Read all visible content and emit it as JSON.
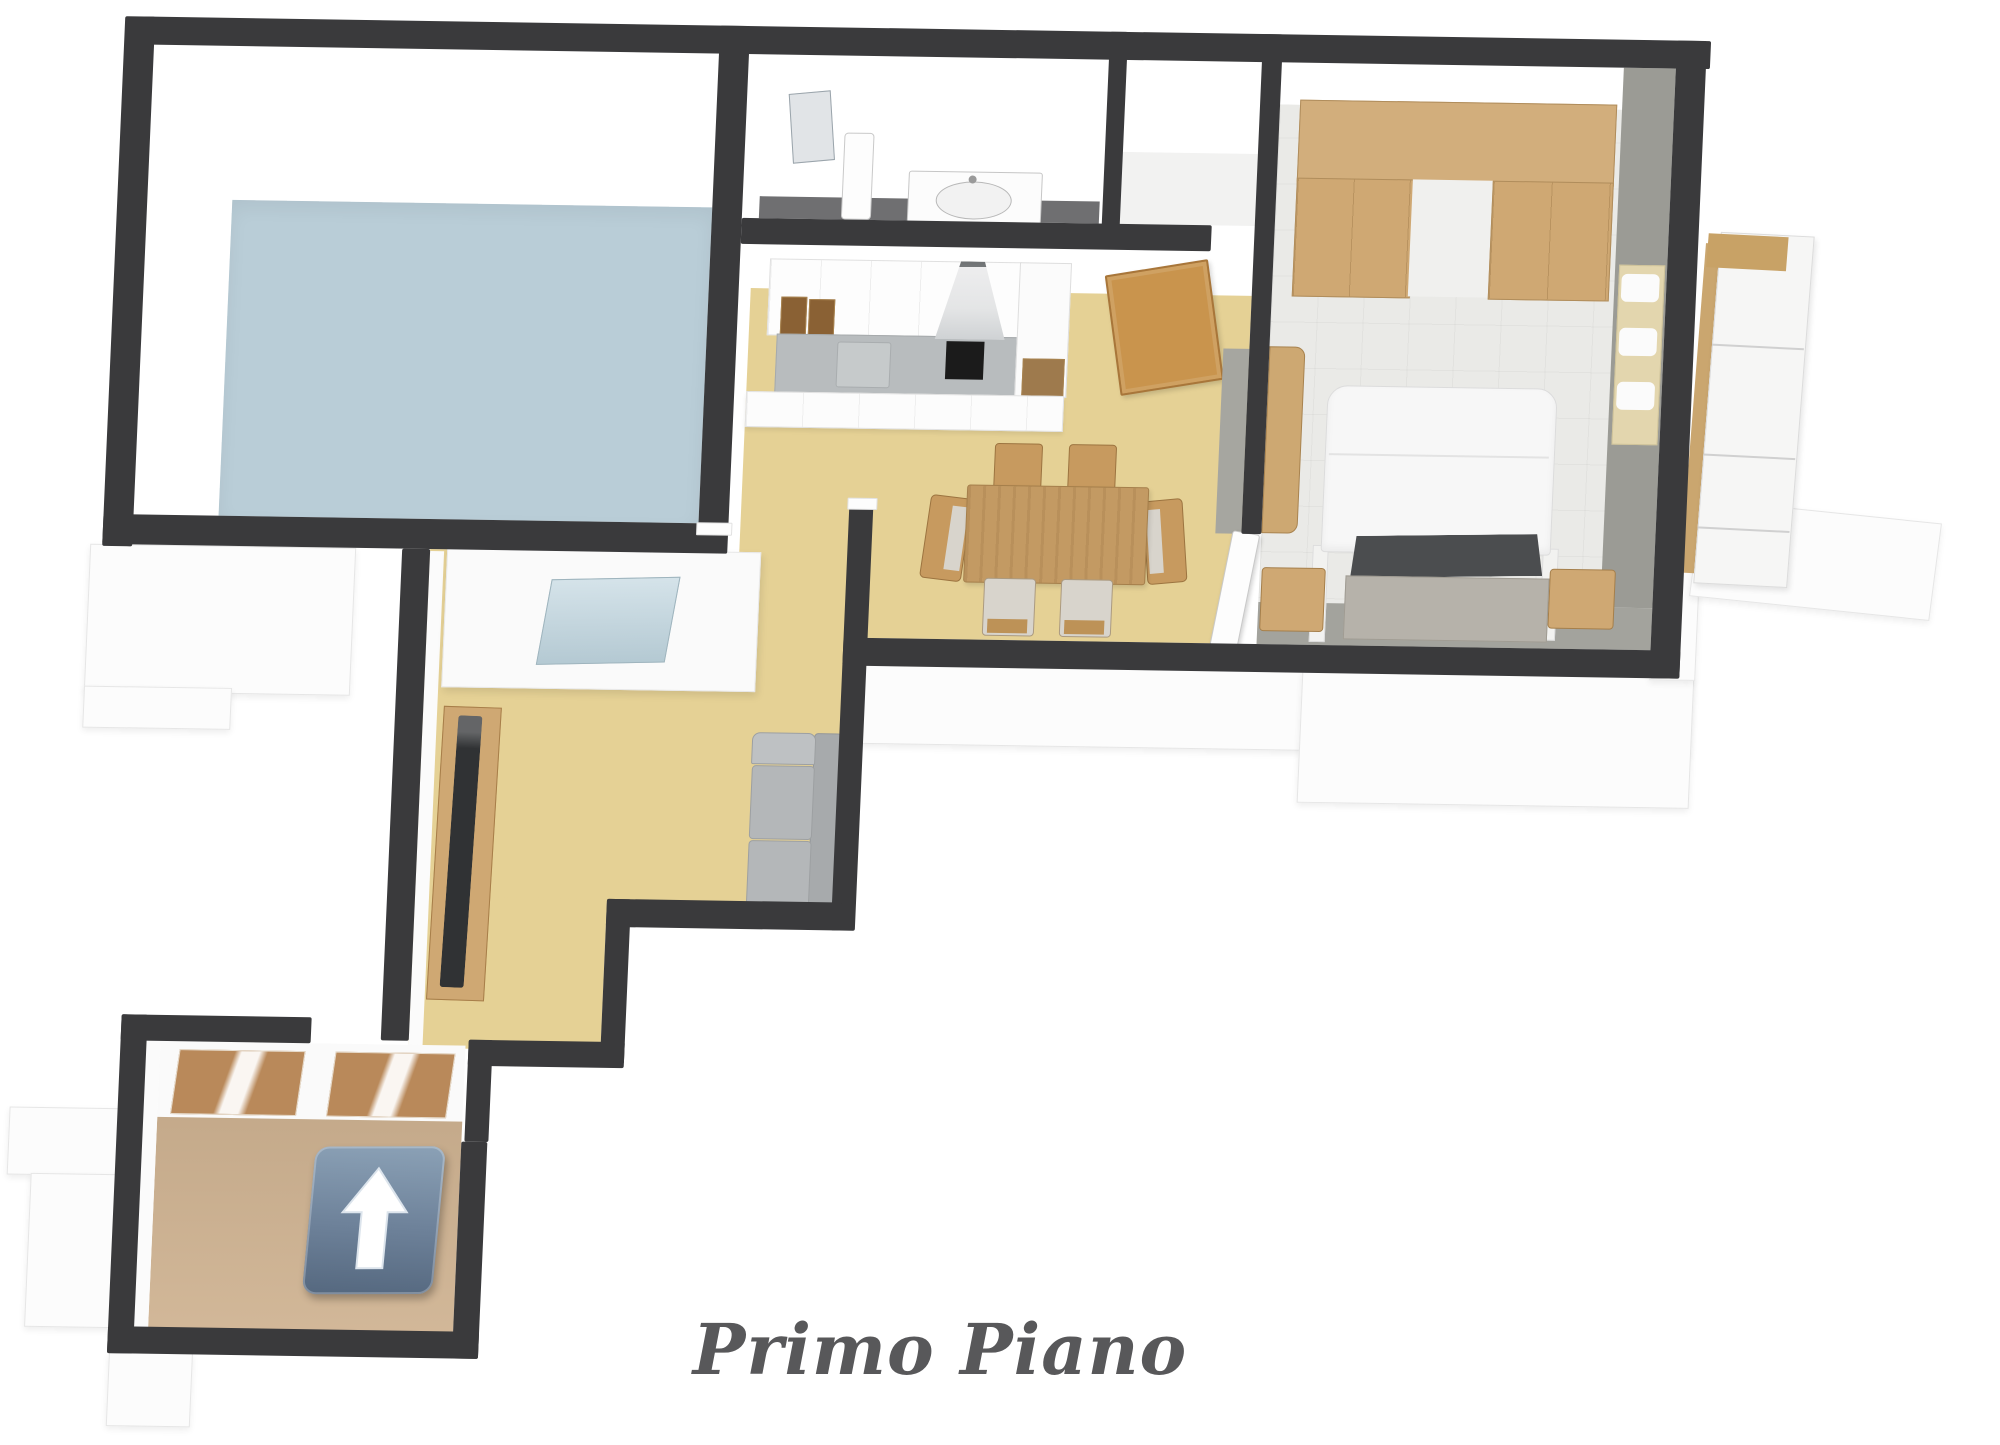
{
  "caption": {
    "text": "Primo Piano"
  },
  "plan_type": "3d-floor-plan",
  "floor_label": "Primo Piano",
  "palette": {
    "wall": "#3a3a3c",
    "wall_face": "#fbfbfb",
    "exterior_slab": "#fcfcfc",
    "floor_blue": "#b9cdd7",
    "floor_yellow": "#e5d195",
    "floor_tan": "#cfb392",
    "floor_bath_gray": "#6f6f71",
    "floor_bedroom": "#eaeae7",
    "bedroom_wall_gray": "#9b9b95",
    "bedroom_wall_gray_bottom": "#a3a39d",
    "door_face_gray": "#a6a6a0",
    "wood": "#cfa873",
    "wood_dark": "#b9905a",
    "wood_table": "#c39a63",
    "wood_tread": "#b9895a",
    "door_tan": "#c9944d",
    "counter_gray": "#b8bcbe",
    "sink_gray": "#c6cacb",
    "cooktop_black": "#1b1b1b",
    "sofa_gray": "#b4b7b9",
    "sofa_back_gray": "#a7aaac",
    "bed_white": "#f7f7f7",
    "bed_base": "#b6b2aa",
    "headboard_gray": "#4b4d4f",
    "radiator_cream": "#e3d6ae",
    "glass_blue": "#bed4de",
    "sign_gradient_top": "#8ba1b6",
    "sign_gradient_bottom": "#55687f",
    "caption_color": "#58585a"
  },
  "rooms": [
    {
      "name": "storage-room",
      "floor": "light-blue"
    },
    {
      "name": "bathroom",
      "floor": "dark-gray"
    },
    {
      "name": "closet",
      "floor": "white"
    },
    {
      "name": "kitchen-dining-room",
      "floor": "yellow"
    },
    {
      "name": "bedroom",
      "floor": "white-tile"
    },
    {
      "name": "living-room",
      "floor": "yellow"
    },
    {
      "name": "corridor",
      "floor": "yellow"
    },
    {
      "name": "entrance-stair-hall",
      "floor": "tan"
    },
    {
      "name": "balcony",
      "floor": "white"
    }
  ],
  "furniture": [
    "shower-glass",
    "pedestal-sink",
    "vanity-sink",
    "kitchen-upper-cabinets",
    "range-hood",
    "cooktop",
    "kitchen-counter",
    "kitchen-base-cabinets",
    "tall-kitchen-column",
    "dining-table",
    "dining-chair-x6",
    "open-door-tan",
    "wardrobe",
    "double-bed",
    "nightstand-left",
    "nightstand-right",
    "bedroom-cabinet",
    "radiator",
    "open-door-white",
    "tv",
    "tv-stand",
    "sofa",
    "stair-treads"
  ],
  "sign": {
    "icon": "up-arrow-icon",
    "direction": "up"
  }
}
